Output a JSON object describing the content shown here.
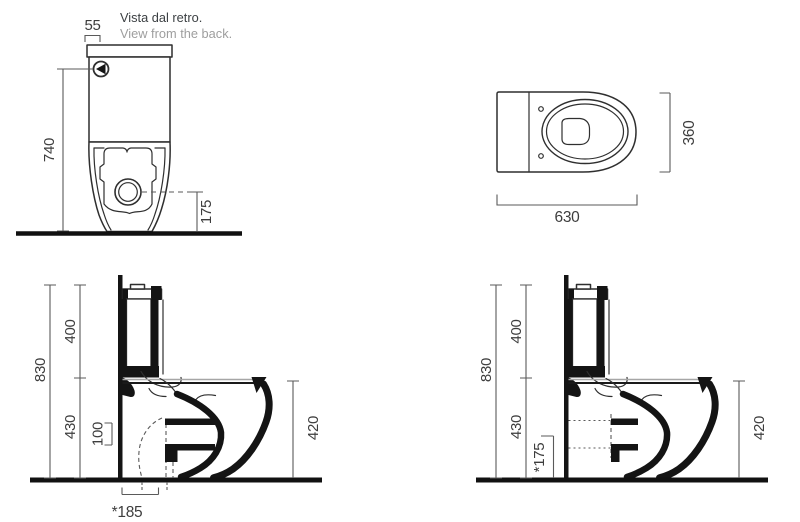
{
  "captions": {
    "italian": "Vista dal retro.",
    "english": "View from the back."
  },
  "back_view": {
    "dim_top_width": "55",
    "dim_height_to_button": "740",
    "dim_outlet_height": "175"
  },
  "top_view": {
    "dim_length": "630",
    "dim_width": "360"
  },
  "side_views": {
    "shared_dims": {
      "total_height": "830",
      "tank_section": "400",
      "bowl_section": "430",
      "rim_height": "420"
    },
    "floor_outlet": {
      "dim_trap_drop": "100",
      "dim_outlet_distance": "*185"
    },
    "wall_outlet": {
      "dim_outlet_height": "*175"
    }
  },
  "colors": {
    "outline": "#2f2f2f",
    "solid_black": "#141414",
    "dimension_line": "#5a5a5a",
    "dimension_text": "#3d3d3d",
    "caption_text": "#3c4043",
    "caption_muted": "#9e9e9e",
    "ground": "#111111",
    "background": "#ffffff"
  }
}
